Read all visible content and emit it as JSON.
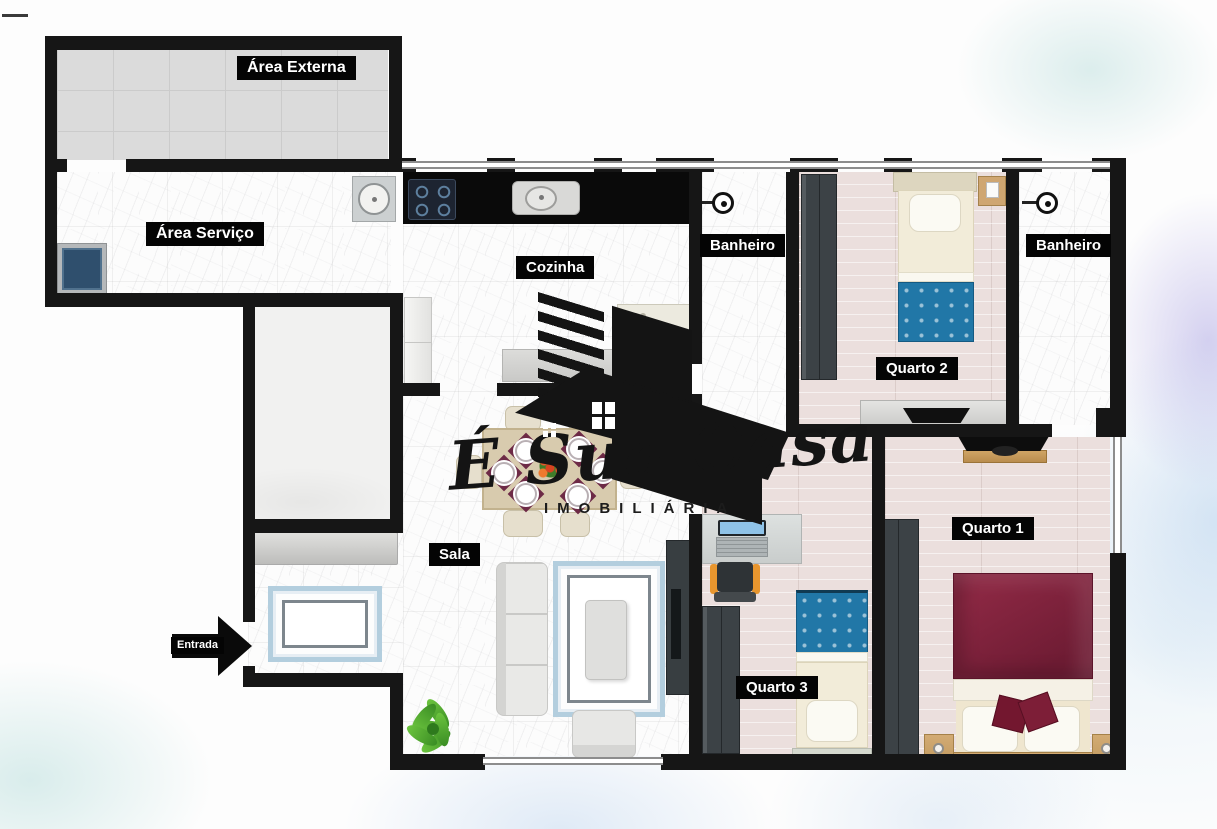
{
  "watermark": {
    "brand_script": "É Sua Casa",
    "brand_sub": "IMOBILIÁRIA"
  },
  "rooms": {
    "area_externa": {
      "label": "Área Externa"
    },
    "area_servico": {
      "label": "Área Serviço"
    },
    "cozinha": {
      "label": "Cozinha"
    },
    "banheiro_1": {
      "label": "Banheiro"
    },
    "banheiro_2": {
      "label": "Banheiro"
    },
    "quarto_1": {
      "label": "Quarto 1"
    },
    "quarto_2": {
      "label": "Quarto 2"
    },
    "quarto_3": {
      "label": "Quarto 3"
    },
    "sala": {
      "label": "Sala"
    },
    "entrada": {
      "label": "Entrada"
    }
  },
  "colors": {
    "wall": "#161616",
    "bedroom_floor": "#ebdfdd",
    "external_floor": "#dbdbdb",
    "blanket_blue": "#2177a7",
    "blanket_maroon": "#7b1f38",
    "wood": "#c8a26c",
    "watercolor_blue": "#a3c3e8",
    "watercolor_lavender": "#a39be0",
    "watercolor_teal": "#aad6d4"
  }
}
